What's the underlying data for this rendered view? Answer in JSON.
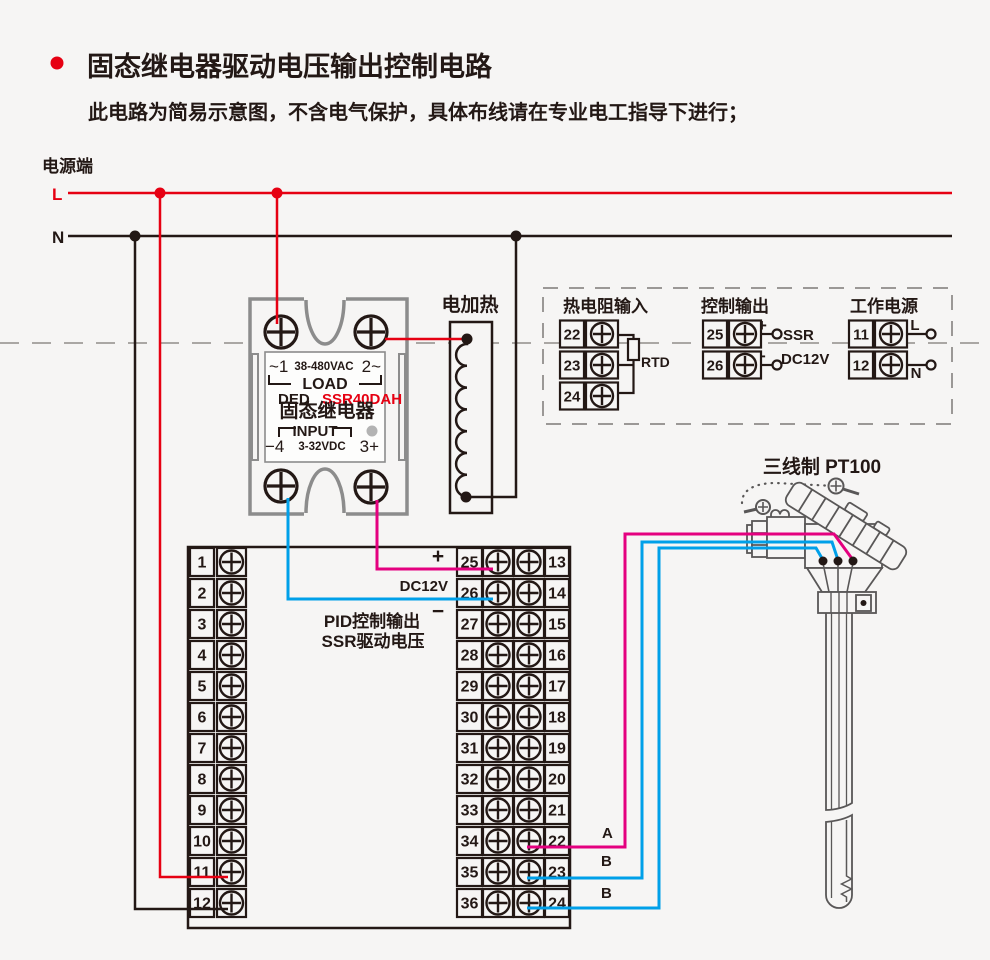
{
  "colors": {
    "background": "#f6f5f4",
    "ink": "#231815",
    "red": "#e60012",
    "magenta": "#e4007f",
    "cyan": "#00a0e9",
    "gray_outline": "#8c8c8c",
    "dash_gray": "#aaa7a4",
    "sensor_gray": "#595757",
    "led_gray": "#b3b3b3"
  },
  "header": {
    "title": "固态继电器驱动电压输出控制电路",
    "subtitle": "此电路为简易示意图，不含电气保护，具体布线请在专业电工指导下进行；"
  },
  "power": {
    "label": "电源端",
    "l_label": "L",
    "n_label": "N"
  },
  "heater": {
    "label": "电加热"
  },
  "ssr": {
    "ac_left": "~1",
    "ac_label": "38-480VAC",
    "ac_right": "2~",
    "load": "LOAD",
    "brand": "DED",
    "model": "SSR40DAH",
    "name": "固态继电器",
    "input": "INPUT",
    "dc_left": "−4",
    "dc_label": "3-32VDC",
    "dc_right": "3+"
  },
  "panel": {
    "rtd": {
      "title": "热电阻输入",
      "terminals": [
        "22",
        "23",
        "24"
      ],
      "label": "RTD"
    },
    "control": {
      "title": "控制输出",
      "terminals": [
        "25",
        "26"
      ],
      "plus": "+",
      "minus": "−",
      "ssr_label": "SSR",
      "dc_label": "DC12V"
    },
    "supply": {
      "title": "工作电源",
      "terminals": [
        "11",
        "12"
      ],
      "l_label": "L",
      "n_label": "N"
    }
  },
  "sensor": {
    "label": "三线制 PT100",
    "wire_a": "A",
    "wire_b_mid": "B",
    "wire_b_bot": "B"
  },
  "terminal_block": {
    "left": [
      "1",
      "2",
      "3",
      "4",
      "5",
      "6",
      "7",
      "8",
      "9",
      "10",
      "11",
      "12"
    ],
    "middle": [
      "25",
      "26",
      "27",
      "28",
      "29",
      "30",
      "31",
      "32",
      "33",
      "34",
      "35",
      "36"
    ],
    "right": [
      "13",
      "14",
      "15",
      "16",
      "17",
      "18",
      "19",
      "20",
      "21",
      "22",
      "23",
      "24"
    ],
    "plus": "+",
    "minus": "−",
    "dc_label": "DC12V",
    "caption_line1": "PID控制输出",
    "caption_line2": "SSR驱动电压"
  }
}
